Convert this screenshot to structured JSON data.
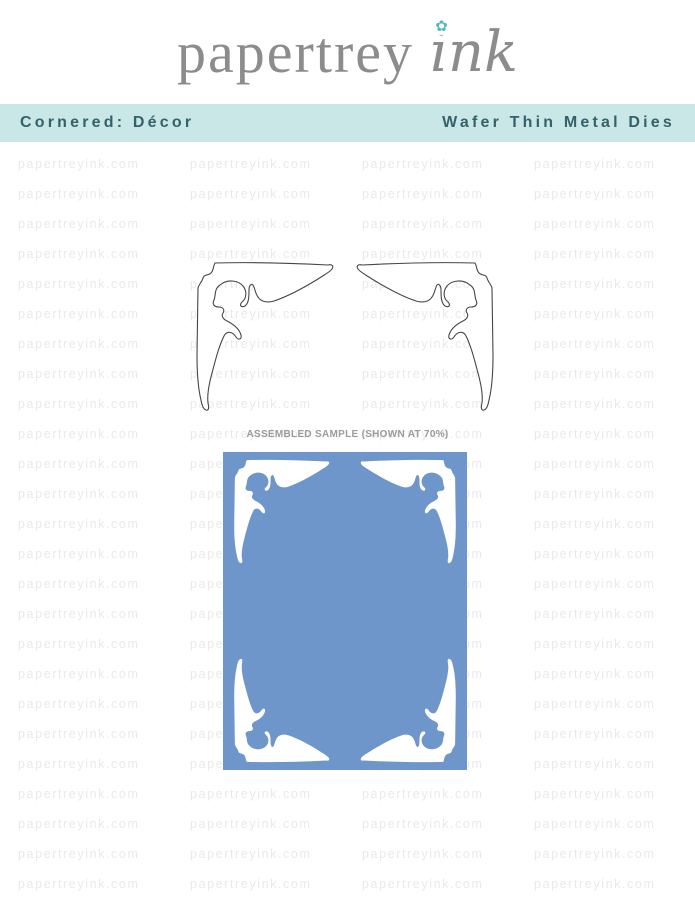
{
  "logo": {
    "word1": "papertrey",
    "word2": "ink",
    "flower_icon": "✿"
  },
  "banner": {
    "left_label": "Cornered: Décor",
    "right_label": "Wafer Thin Metal Dies"
  },
  "watermark": {
    "text": "papertreyink.com"
  },
  "sample": {
    "label": "ASSEMBLED SAMPLE (SHOWN AT 70%)"
  },
  "product": {
    "name": "Cornered: Décor",
    "category": "Wafer Thin Metal Dies",
    "die_count": 2,
    "die_shape": "ornate corner flourish, left and right mirrored pair"
  },
  "colors": {
    "logo_gray": "#8c8c8c",
    "flower_teal": "#54b8bc",
    "banner_bg": "#c9e7e6",
    "banner_text": "#35626a",
    "watermark_gray": "#ebe9e8",
    "label_gray": "#9b9b9b",
    "card_blue": "#6e96cb",
    "die_outline": "#454545",
    "die_fill": "#ffffff"
  }
}
